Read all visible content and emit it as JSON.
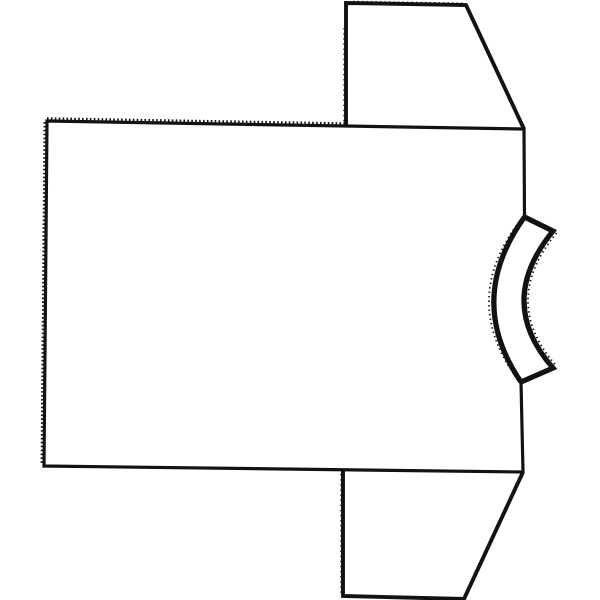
{
  "theme": {
    "background": "#ffffff",
    "line": "#121212"
  },
  "drawing": {
    "alt": "Black-and-white line drawing of a blank short-sleeve T-shirt lying sideways, collar band on the right side",
    "canvas": {
      "width": 600,
      "height": 600
    },
    "shapes": {
      "body_outline": "M 47 121 L 524 129 L 524.5 217 L 553 231 Q 495 302 553 368 L 521 382 L 523 472 L 44 466 Z",
      "top_sleeve": "M 346 126 L 346 3 L 466 5 L 524 129",
      "bottom_sleeve": "M 343 471 L 343 596 L 464 599 L 523 472",
      "collar_band": "M 524.5 217 L 553 231 Q 495 302 553 368 L 521 382",
      "neckline_arc": "M 524.5 217 Q 465 300 521 382",
      "top_edge_notches": "M 47 118.4 L 346 123.4",
      "left_edge_notches": "M 44.7 122 L 41.7 465",
      "top_sleeve_edge_notches": "M 353 1.6 L 464 3.4",
      "top_sleeve_fold_dots": "M 344.2 28 L 344.2 124",
      "bottom_sleeve_fold_dots": "M 341.2 474 L 341.2 594",
      "neckline_rough": "M 519 222 Q 460.5 300 516 377",
      "collar_inner_rough": "M 556.5 233 Q 499.5 302 556.5 366"
    }
  }
}
